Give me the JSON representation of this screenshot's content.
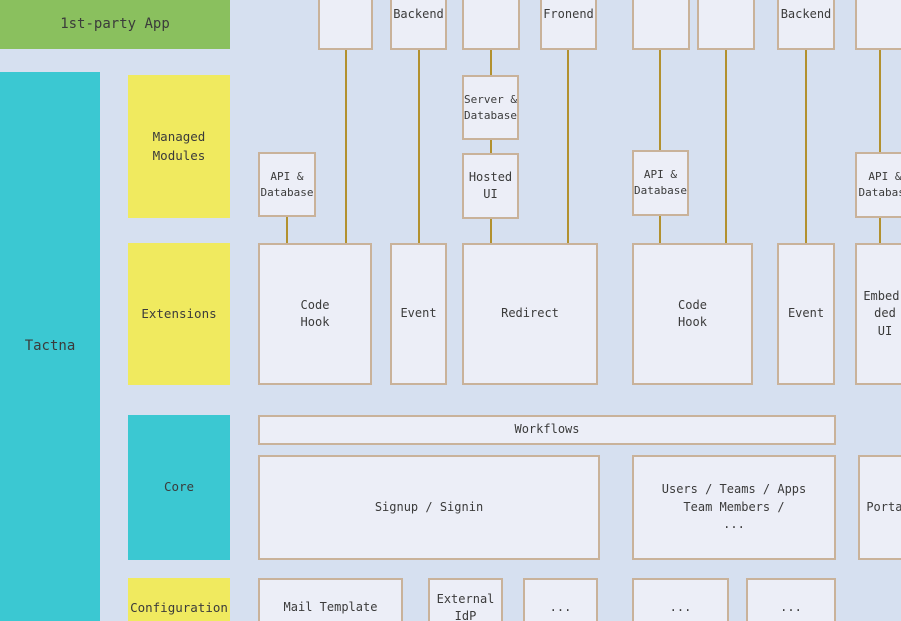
{
  "colors": {
    "background": "#d6e0f0",
    "node_fill": "#eceef7",
    "node_border": "#c9b29a",
    "connector": "#b2912f",
    "green": "#8ac05e",
    "cyan": "#3bc8d2",
    "yellow": "#f0ea5f",
    "text": "#3b3b3b"
  },
  "lanes": {
    "first_party_app": "1st-party App",
    "platform": "Tactna",
    "rows": [
      {
        "label": "Managed Modules"
      },
      {
        "label": "Extensions"
      },
      {
        "label": "Core"
      },
      {
        "label": "Configuration"
      }
    ]
  },
  "top_boxes": [
    {
      "label": ""
    },
    {
      "label": "Backend"
    },
    {
      "label": ""
    },
    {
      "label": "Fronend"
    },
    {
      "label": ""
    },
    {
      "label": ""
    },
    {
      "label": "Backend"
    },
    {
      "label": ""
    }
  ],
  "managed_modules": {
    "api_database_left": "API &\nDatabase",
    "server_database": "Server &\nDatabase",
    "hosted_ui": "Hosted\nUI",
    "api_database_mid": "API &\nDatabase",
    "api_database_right": "API &\nDatabase"
  },
  "extensions": {
    "code_hook_left": "Code\nHook",
    "event_left": "Event",
    "redirect": "Redirect",
    "code_hook_right": "Code\nHook",
    "event_right": "Event",
    "embedded_ui": "Embed-\nded\nUI"
  },
  "core": {
    "workflows": "Workflows",
    "signup_signin": "Signup / Signin",
    "users_teams": "Users / Teams / Apps\nTeam Members /\n...",
    "portal": "Portal"
  },
  "configuration": {
    "mail_template": "Mail Template",
    "external_idp": "External\nIdP",
    "more_1": "...",
    "more_2": "...",
    "more_3": "..."
  }
}
